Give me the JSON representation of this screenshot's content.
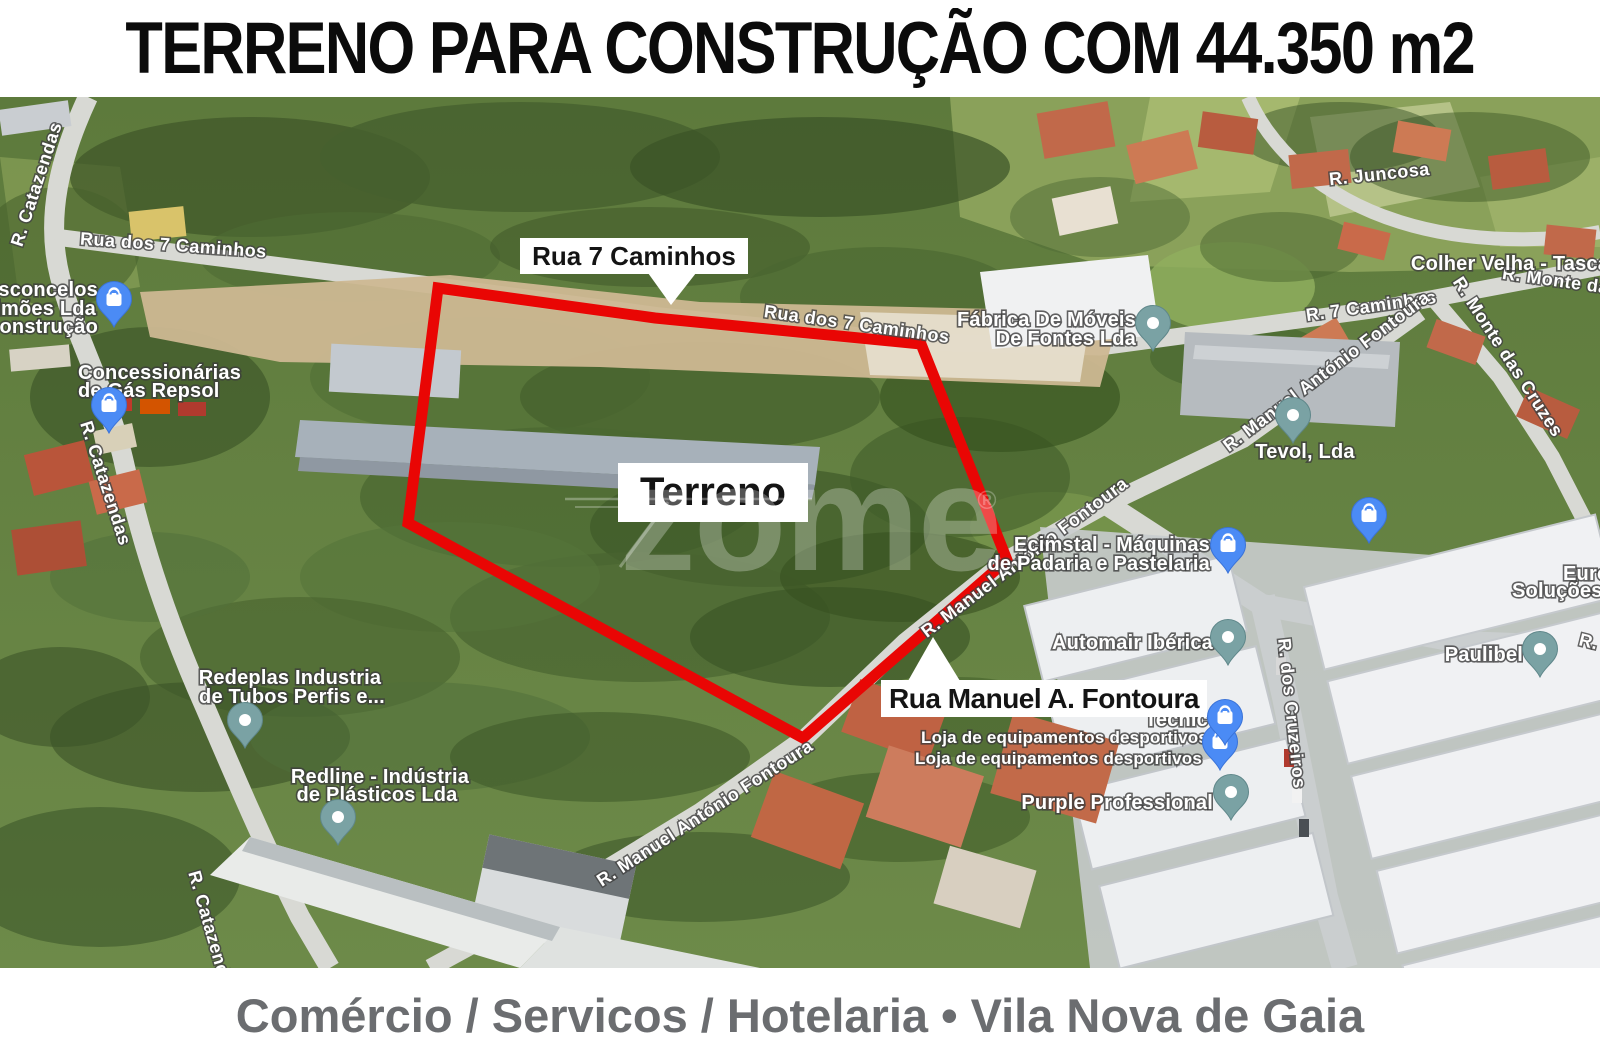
{
  "header": {
    "title": "TERRENO PARA CONSTRUÇÃO COM 44.350 m2"
  },
  "footer": {
    "text": "Comércio / Servicos / Hotelaria • Vila Nova de Gaia"
  },
  "watermark": {
    "text": "zome",
    "reg": "®"
  },
  "map": {
    "parcel_outline_color": "#e90604",
    "pin_colors": {
      "shop": "#4b8bf5",
      "generic": "#7aa2a4"
    },
    "callouts": {
      "street_top": "Rua 7 Caminhos",
      "parcel": "Terreno",
      "street_bottom": "Rua Manuel A. Fontoura"
    },
    "roads": {
      "catazendas": "R. Catazendas",
      "dos7caminhos": "Rua dos 7 Caminhos",
      "juncosa": "R. Juncosa",
      "r7caminhos": "R. 7 Caminhos",
      "montedas": "R. Monte das",
      "montecruzes": "R. Monte das Cruzes",
      "manuelfontoura": "R. Manuel António Fontoura",
      "cruzeiros": "R. dos Cruzeiros",
      "rdos": "R. dos"
    },
    "places": {
      "vasconcelos": {
        "lines": [
          "Vasconcelos",
          "Simões Lda",
          "de construção"
        ]
      },
      "concessionarias": {
        "lines": [
          "Concessionárias",
          "de Gás Repsol"
        ]
      },
      "fabrica": {
        "lines": [
          "Fábrica De Móveis",
          "De Fontes Lda"
        ]
      },
      "tevol": "Tevol, Lda",
      "colher": "Colher Velha - Tasca",
      "ecimstal": {
        "lines": [
          "Ecimstal - Máquinas",
          "de Padaria e Pastelaria"
        ]
      },
      "automair": "Automair Ibérica",
      "tecnic": "Tecnic",
      "loja": "Loja de equipamentos desportivos",
      "purple": "Purple Professional",
      "redeplas": {
        "lines": [
          "Redeplas Industria",
          "de Tubos Perfis e..."
        ]
      },
      "redline": {
        "lines": [
          "Redline - Indústria",
          "de Plásticos Lda"
        ]
      },
      "paulibel": "Paulibel",
      "euro": {
        "lines": [
          "Euro",
          "Soluções Indu"
        ]
      }
    }
  }
}
